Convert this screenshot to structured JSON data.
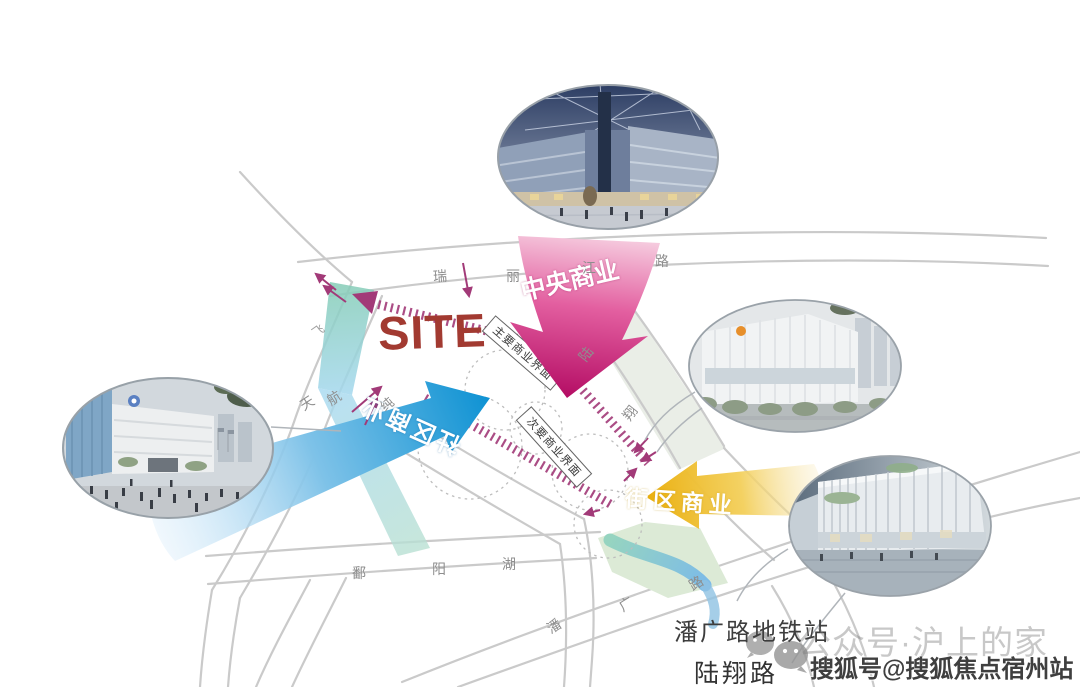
{
  "site": {
    "label": "SITE"
  },
  "flows": {
    "central": {
      "label": "中央商业",
      "color": "#c0136b"
    },
    "community": {
      "label": "社区商业",
      "color": "#1694d4"
    },
    "block": {
      "label": "街区商业",
      "color": "#edb313"
    }
  },
  "interfaces": {
    "primary": "主要商业界面",
    "secondary": "次要商业界面"
  },
  "roads": {
    "ruilijiang": [
      "瑞",
      "丽",
      "江",
      "路"
    ],
    "upper_left": "飞",
    "tianhang": [
      "天",
      "航"
    ],
    "mid_cross": "纯",
    "luxiang_diagonal": [
      "陆",
      "翔"
    ],
    "poyanghu": [
      "鄱",
      "阳",
      "湖"
    ],
    "panguang": [
      "潘",
      "广",
      "路"
    ]
  },
  "landmarks": {
    "metro_station": "潘广路地铁站",
    "luxiang_road": "陆翔路"
  },
  "watermarks": {
    "wechat": "公众号·沪上的家",
    "sohu": "搜狐号@搜狐焦点宿州站"
  },
  "icons": {
    "wechat_bubbles": "wechat-icon"
  },
  "photos": {
    "top": "mall-interior-atrium-rendering",
    "right": "shopping-mall-day-rendering",
    "bottom_right": "shopping-mall-evening-rendering",
    "left": "mall-plaza-crowd-rendering"
  }
}
